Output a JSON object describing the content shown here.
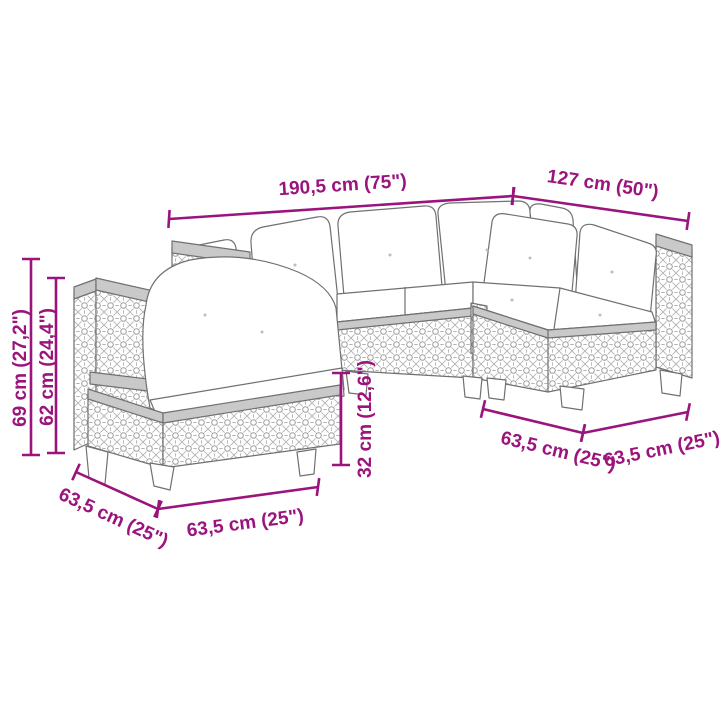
{
  "page": {
    "background": "#ffffff",
    "description": "Line-drawing dimension diagram of a 5-piece poly rattan garden lounge set with white cushions"
  },
  "diagram": {
    "accent_color": "#9B147D",
    "outline_color": "#707070",
    "product": "rattan-corner-sofa-set",
    "dimensions": {
      "total_width": "190,5 cm (75\")",
      "right_width": "127 cm (50\")",
      "overall_height": "69 cm (27,2\")",
      "back_height": "62 cm (24,4\")",
      "seat_height": "32 cm (12,6\")",
      "chair_side_depth": "63,5 cm (25\")",
      "chair_front_width": "63,5 cm (25\")",
      "right_module_depth": "63,5 cm (25\")",
      "right_module_width": "63,5 cm (25\")"
    }
  }
}
